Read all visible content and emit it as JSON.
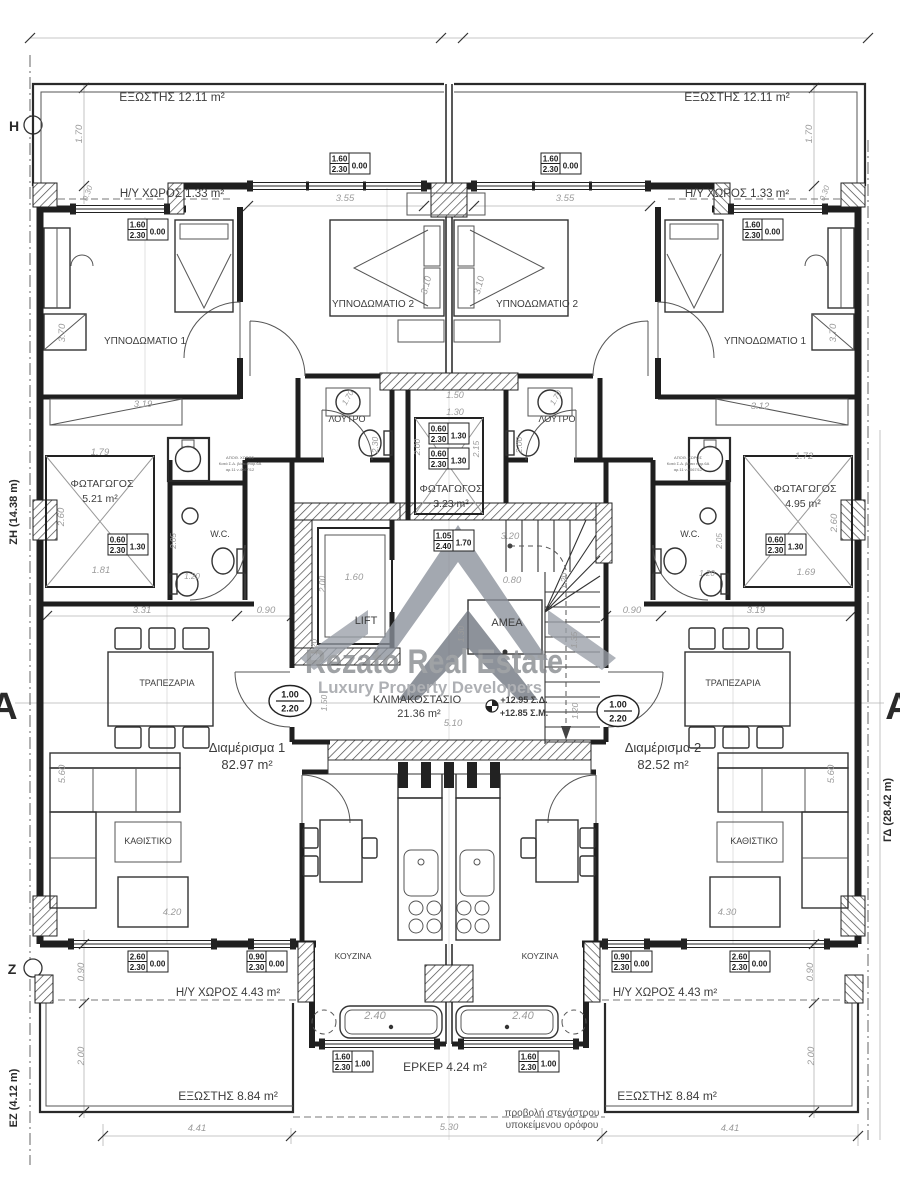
{
  "watermark": {
    "line1": "Rezato  Real Estate",
    "line2": "Luxury  Property  Developers",
    "color": "#85888d"
  },
  "labels": {
    "rooms": [
      {
        "t": "ΕΞΩΣΤΗΣ 12.11 m²",
        "x": 172,
        "y": 101,
        "s": 12
      },
      {
        "t": "ΕΞΩΣΤΗΣ 12.11 m²",
        "x": 737,
        "y": 101,
        "s": 12
      },
      {
        "t": "Η/Υ ΧΩΡΟΣ 1.33 m²",
        "x": 172,
        "y": 197,
        "s": 11.5
      },
      {
        "t": "Η/Υ ΧΩΡΟΣ 1.33 m²",
        "x": 737,
        "y": 197,
        "s": 11.5
      },
      {
        "t": "ΥΠΝΟΔΩΜΑΤΙΟ 1",
        "x": 145,
        "y": 344,
        "s": 10
      },
      {
        "t": "ΥΠΝΟΔΩΜΑΤΙΟ 2",
        "x": 373,
        "y": 307,
        "s": 10
      },
      {
        "t": "ΥΠΝΟΔΩΜΑΤΙΟ 2",
        "x": 537,
        "y": 307,
        "s": 10
      },
      {
        "t": "ΥΠΝΟΔΩΜΑΤΙΟ 1",
        "x": 765,
        "y": 344,
        "s": 10
      },
      {
        "t": "ΛΟΥΤΡΟ",
        "x": 347,
        "y": 422,
        "s": 9
      },
      {
        "t": "ΛΟΥΤΡΟ",
        "x": 557,
        "y": 422,
        "s": 9
      },
      {
        "t": "ΦΩΤΑΓΩΓΟΣ",
        "x": 102,
        "y": 487,
        "s": 10.5
      },
      {
        "t": "5.21 m²",
        "x": 100,
        "y": 502,
        "s": 10.5
      },
      {
        "t": "ΦΩΤΑΓΩΓΟΣ",
        "x": 451,
        "y": 492,
        "s": 10.5
      },
      {
        "t": "3.23 m²",
        "x": 451,
        "y": 507,
        "s": 10.5
      },
      {
        "t": "ΦΩΤΑΓΩΓΟΣ",
        "x": 805,
        "y": 492,
        "s": 10.5
      },
      {
        "t": "4.95 m²",
        "x": 803,
        "y": 507,
        "s": 10.5
      },
      {
        "t": "W.C.",
        "x": 220,
        "y": 537,
        "s": 9
      },
      {
        "t": "W.C.",
        "x": 690,
        "y": 537,
        "s": 9
      },
      {
        "t": "LIFT",
        "x": 366,
        "y": 624,
        "s": 11
      },
      {
        "t": "ΑΜΕΑ",
        "x": 507,
        "y": 626,
        "s": 11
      },
      {
        "t": "ΚΛΙΜΑΚΟΣΤΑΣΙΟ",
        "x": 417,
        "y": 703,
        "s": 11
      },
      {
        "t": "21.36 m²",
        "x": 419,
        "y": 717,
        "s": 11
      },
      {
        "t": "ΤΡΑΠΕΖΑΡΙΑ",
        "x": 167,
        "y": 686,
        "s": 9
      },
      {
        "t": "ΤΡΑΠΕΖΑΡΙΑ",
        "x": 733,
        "y": 686,
        "s": 9
      },
      {
        "t": "Διαμέρισμα 1",
        "x": 247,
        "y": 752,
        "s": 13
      },
      {
        "t": "82.97 m²",
        "x": 247,
        "y": 769,
        "s": 13
      },
      {
        "t": "Διαμέρισμα 2",
        "x": 663,
        "y": 752,
        "s": 13
      },
      {
        "t": "82.52 m²",
        "x": 663,
        "y": 769,
        "s": 13
      },
      {
        "t": "ΚΑΘΙΣΤΙΚΟ",
        "x": 148,
        "y": 844,
        "s": 9
      },
      {
        "t": "ΚΑΘΙΣΤΙΚΟ",
        "x": 754,
        "y": 844,
        "s": 9
      },
      {
        "t": "ΚΟΥΖΙΝΑ",
        "x": 353,
        "y": 959,
        "s": 8.5
      },
      {
        "t": "ΚΟΥΖΙΝΑ",
        "x": 540,
        "y": 959,
        "s": 8.5
      },
      {
        "t": "Η/Υ ΧΩΡΟΣ 4.43 m²",
        "x": 228,
        "y": 996,
        "s": 11.5
      },
      {
        "t": "Η/Υ ΧΩΡΟΣ 4.43 m²",
        "x": 665,
        "y": 996,
        "s": 11.5
      },
      {
        "t": "ΕΞΩΣΤΗΣ 8.84 m²",
        "x": 228,
        "y": 1100,
        "s": 12
      },
      {
        "t": "ΕΞΩΣΤΗΣ 8.84 m²",
        "x": 667,
        "y": 1100,
        "s": 12
      },
      {
        "t": "ΕΡΚΕΡ 4.24 m²",
        "x": 445,
        "y": 1071,
        "s": 12
      },
      {
        "t": "+12.95 Σ.Δ.",
        "x": 524,
        "y": 703,
        "s": 9,
        "b": 1,
        "a": "middle"
      },
      {
        "t": "+12.85 Σ.Μ.",
        "x": 524,
        "y": 716,
        "s": 9,
        "b": 1,
        "a": "middle"
      }
    ],
    "notes": [
      {
        "t": "προβολή στεγάστρου",
        "x": 552,
        "y": 1116,
        "s": 10
      },
      {
        "t": "υποκείμενου ορόφου",
        "x": 552,
        "y": 1128,
        "s": 10
      }
    ],
    "tiny": [
      {
        "t": "ΑΠΟΘ. ΧΩΡΟΣ",
        "x": 240,
        "y": 459,
        "s": 4
      },
      {
        "t": "Κατά Σ.Δ. βάσει παρ.6Α",
        "x": 240,
        "y": 465,
        "s": 4
      },
      {
        "t": "αρ.11 ν.4067/12",
        "x": 240,
        "y": 471,
        "s": 4
      },
      {
        "t": "ΑΠΟΘ. ΧΩΡΟΣ",
        "x": 688,
        "y": 459,
        "s": 4
      },
      {
        "t": "Κατά Σ.Δ. βάσει παρ.6Α",
        "x": 688,
        "y": 465,
        "s": 4
      },
      {
        "t": "αρ.11 ν.4067/12",
        "x": 688,
        "y": 471,
        "s": 4
      }
    ],
    "axes": [
      {
        "t": "H",
        "x": 14,
        "y": 131,
        "s": 14
      },
      {
        "t": "Z",
        "x": 12,
        "y": 974,
        "s": 14
      },
      {
        "t": "A",
        "x": 4,
        "y": 719,
        "s": 38
      },
      {
        "t": "A",
        "x": 899,
        "y": 719,
        "s": 38
      },
      {
        "t": "ΖΗ (14.38 m)",
        "x": 17,
        "y": 512,
        "s": 11,
        "r": -90
      },
      {
        "t": "ΕΖ (4.12 m)",
        "x": 17,
        "y": 1098,
        "s": 11,
        "r": -90
      },
      {
        "t": "ΓΔ (28.42 m)",
        "x": 891,
        "y": 810,
        "s": 11,
        "r": -90
      }
    ],
    "dims": [
      {
        "t": "1.70",
        "x": 82,
        "y": 134,
        "r": -90
      },
      {
        "t": "1.70",
        "x": 812,
        "y": 134,
        "r": -90
      },
      {
        "t": "0.30",
        "x": 90,
        "y": 194,
        "r": -70,
        "s": 8
      },
      {
        "t": "0.30",
        "x": 827,
        "y": 194,
        "r": -70,
        "s": 8
      },
      {
        "t": "3.55",
        "x": 345,
        "y": 201
      },
      {
        "t": "3.55",
        "x": 565,
        "y": 201
      },
      {
        "t": "3.10",
        "x": 429,
        "y": 286,
        "r": -75
      },
      {
        "t": "3.10",
        "x": 482,
        "y": 286,
        "r": -75
      },
      {
        "t": "3.70",
        "x": 65,
        "y": 333,
        "r": -90
      },
      {
        "t": "3.70",
        "x": 836,
        "y": 333,
        "r": -90
      },
      {
        "t": "3.19",
        "x": 143,
        "y": 407
      },
      {
        "t": "3.12",
        "x": 760,
        "y": 409
      },
      {
        "t": "1.79",
        "x": 100,
        "y": 455
      },
      {
        "t": "1.72",
        "x": 804,
        "y": 459
      },
      {
        "t": "2.60",
        "x": 64,
        "y": 517,
        "r": -90
      },
      {
        "t": "2.60",
        "x": 837,
        "y": 523,
        "r": -90
      },
      {
        "t": "1.81",
        "x": 101,
        "y": 573
      },
      {
        "t": "1.69",
        "x": 806,
        "y": 575
      },
      {
        "t": "1.50",
        "x": 455,
        "y": 398,
        "s": 9
      },
      {
        "t": "1.30",
        "x": 455,
        "y": 415,
        "s": 9
      },
      {
        "t": "2.00",
        "x": 420,
        "y": 447,
        "r": -90,
        "s": 8.5
      },
      {
        "t": "2.15",
        "x": 479,
        "y": 449,
        "r": -90,
        "s": 8.5
      },
      {
        "t": "2.30",
        "x": 378,
        "y": 445,
        "r": -90,
        "s": 8.5
      },
      {
        "t": "2.00",
        "x": 522,
        "y": 445,
        "r": -90,
        "s": 8.5
      },
      {
        "t": "1.70",
        "x": 350,
        "y": 399,
        "r": -60,
        "s": 8
      },
      {
        "t": "1.70",
        "x": 558,
        "y": 399,
        "r": -60,
        "s": 8
      },
      {
        "t": "2.05",
        "x": 176,
        "y": 541,
        "r": -90,
        "s": 8
      },
      {
        "t": "2.05",
        "x": 722,
        "y": 541,
        "r": -90,
        "s": 8
      },
      {
        "t": "1.20",
        "x": 192,
        "y": 579,
        "s": 8
      },
      {
        "t": "1.20",
        "x": 707,
        "y": 576,
        "s": 8
      },
      {
        "t": "3.20",
        "x": 510,
        "y": 539
      },
      {
        "t": "0.80",
        "x": 512,
        "y": 583
      },
      {
        "t": "1.20",
        "x": 567,
        "y": 581,
        "r": -90,
        "s": 8.5
      },
      {
        "t": "1.35",
        "x": 577,
        "y": 640,
        "r": -90,
        "s": 8.5
      },
      {
        "t": "1.30",
        "x": 464,
        "y": 634,
        "r": -90,
        "s": 8.5
      },
      {
        "t": "1.50",
        "x": 327,
        "y": 703,
        "r": -90,
        "s": 8.5
      },
      {
        "t": "1.20",
        "x": 578,
        "y": 711,
        "r": -90,
        "s": 8.5
      },
      {
        "t": "2.00",
        "x": 325,
        "y": 584,
        "r": -90,
        "s": 8.5
      },
      {
        "t": "1.60",
        "x": 354,
        "y": 580
      },
      {
        "t": "1.20",
        "x": 317,
        "y": 647,
        "r": -90,
        "s": 8.5
      },
      {
        "t": "5.10",
        "x": 453,
        "y": 726
      },
      {
        "t": "3.31",
        "x": 142,
        "y": 613
      },
      {
        "t": "0.90",
        "x": 266,
        "y": 613
      },
      {
        "t": "0.90",
        "x": 632,
        "y": 613
      },
      {
        "t": "3.19",
        "x": 756,
        "y": 613
      },
      {
        "t": "5.60",
        "x": 65,
        "y": 774,
        "r": -90
      },
      {
        "t": "5.60",
        "x": 834,
        "y": 774,
        "r": -90
      },
      {
        "t": "4.20",
        "x": 172,
        "y": 915
      },
      {
        "t": "4.30",
        "x": 727,
        "y": 915
      },
      {
        "t": "2.40",
        "x": 375,
        "y": 1019,
        "s": 11
      },
      {
        "t": "2.40",
        "x": 523,
        "y": 1019,
        "s": 11
      },
      {
        "t": "0.90",
        "x": 84,
        "y": 972,
        "r": -90
      },
      {
        "t": "0.90",
        "x": 813,
        "y": 972,
        "r": -90
      },
      {
        "t": "2.00",
        "x": 84,
        "y": 1056,
        "r": -90
      },
      {
        "t": "2.00",
        "x": 814,
        "y": 1056,
        "r": -90
      },
      {
        "t": "4.41",
        "x": 197,
        "y": 1131
      },
      {
        "t": "5.30",
        "x": 449,
        "y": 1130
      },
      {
        "t": "4.41",
        "x": 730,
        "y": 1131
      }
    ]
  },
  "window_tags": [
    {
      "x": 330,
      "y": 153,
      "top": "1.60",
      "bot": "2.30",
      "side": "0.00"
    },
    {
      "x": 541,
      "y": 153,
      "top": "1.60",
      "bot": "2.30",
      "side": "0.00"
    },
    {
      "x": 128,
      "y": 219,
      "top": "1.60",
      "bot": "2.30",
      "side": "0.00"
    },
    {
      "x": 743,
      "y": 219,
      "top": "1.60",
      "bot": "2.30",
      "side": "0.00"
    },
    {
      "x": 108,
      "y": 534,
      "top": "0.60",
      "bot": "2.30",
      "side": "1.30"
    },
    {
      "x": 429,
      "y": 423,
      "top": "0.60",
      "bot": "2.30",
      "side": "1.30"
    },
    {
      "x": 429,
      "y": 448,
      "top": "0.60",
      "bot": "2.30",
      "side": "1.30"
    },
    {
      "x": 766,
      "y": 534,
      "top": "0.60",
      "bot": "2.30",
      "side": "1.30"
    },
    {
      "x": 434,
      "y": 530,
      "top": "1.05",
      "bot": "2.40",
      "side": "1.70"
    },
    {
      "x": 128,
      "y": 951,
      "top": "2.60",
      "bot": "2.30",
      "side": "0.00"
    },
    {
      "x": 247,
      "y": 951,
      "top": "0.90",
      "bot": "2.30",
      "side": "0.00"
    },
    {
      "x": 612,
      "y": 951,
      "top": "0.90",
      "bot": "2.30",
      "side": "0.00"
    },
    {
      "x": 730,
      "y": 951,
      "top": "2.60",
      "bot": "2.30",
      "side": "0.00"
    },
    {
      "x": 333,
      "y": 1051,
      "top": "1.60",
      "bot": "2.30",
      "side": "1.00"
    },
    {
      "x": 519,
      "y": 1051,
      "top": "1.60",
      "bot": "2.30",
      "side": "1.00"
    }
  ],
  "door_tags": [
    {
      "x": 290,
      "y": 701,
      "top": "1.00",
      "bot": "2.20"
    },
    {
      "x": 618,
      "y": 711,
      "top": "1.00",
      "bot": "2.20"
    }
  ]
}
